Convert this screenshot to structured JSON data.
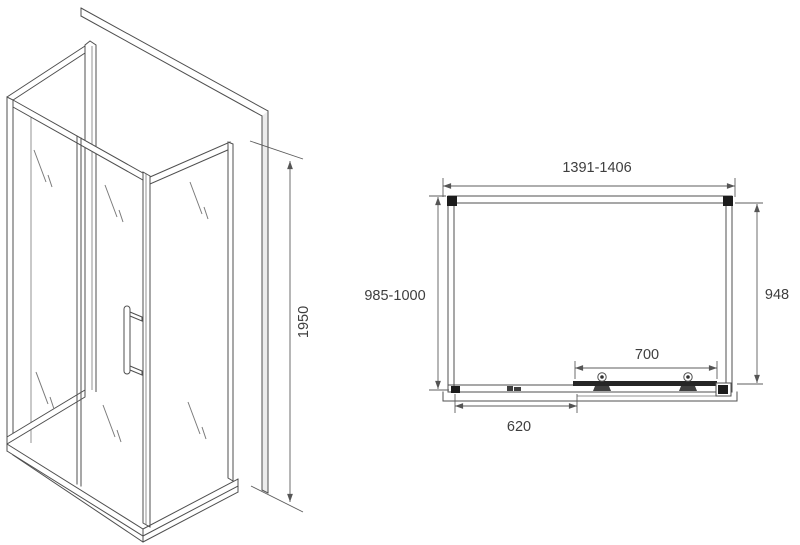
{
  "drawing": {
    "background_color": "#ffffff",
    "line_color": "#4f4f4f",
    "labels": {
      "height": "1950",
      "overall_width": "1391-1406",
      "left_depth": "985-1000",
      "right_depth": "948",
      "door_width": "700",
      "fixed_panel_width": "620"
    },
    "icons": {
      "door_roller": "circle-with-bracket",
      "wall_profile": "filled-square",
      "glass_reflection": "double-slash"
    }
  }
}
